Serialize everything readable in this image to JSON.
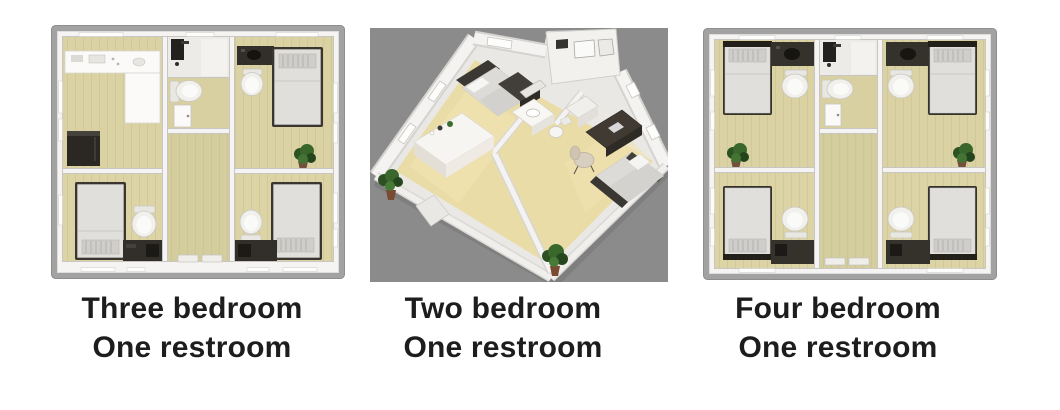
{
  "page": {
    "background_color": "#ffffff"
  },
  "cards": [
    {
      "name": "three-bedroom-plan",
      "view": "top-down floor plan",
      "caption": {
        "line1": "Three bedroom",
        "line2": "One restroom"
      }
    },
    {
      "name": "two-bedroom-plan",
      "view": "isometric 3d floor plan",
      "caption": {
        "line1": "Two bedroom",
        "line2": "One restroom"
      }
    },
    {
      "name": "four-bedroom-plan",
      "view": "top-down floor plan",
      "caption": {
        "line1": "Four bedroom",
        "line2": "One restroom"
      }
    }
  ],
  "icons": [
    "bed-icon",
    "toilet-icon",
    "plant-icon",
    "kitchen-counter-icon",
    "fridge-icon",
    "shower-icon",
    "door-icon",
    "desk-icon",
    "chair-icon",
    "sink-vanity-icon",
    "window-icon"
  ],
  "colors": {
    "caption_text": "#1d1d1d",
    "panel_frame": "#a2a2a2",
    "wall_white": "#f5f4f2",
    "floor_tan": "#dbd2a4",
    "hallway_floor": "#d4cd9d",
    "restroom_tile": "#ecebe7",
    "iso_background": "#8b8b8b",
    "iso_floor": "#eadda9",
    "dark_furniture": "#322e29",
    "mattress": "#e0dfdc",
    "plant_green": "#39662b"
  }
}
